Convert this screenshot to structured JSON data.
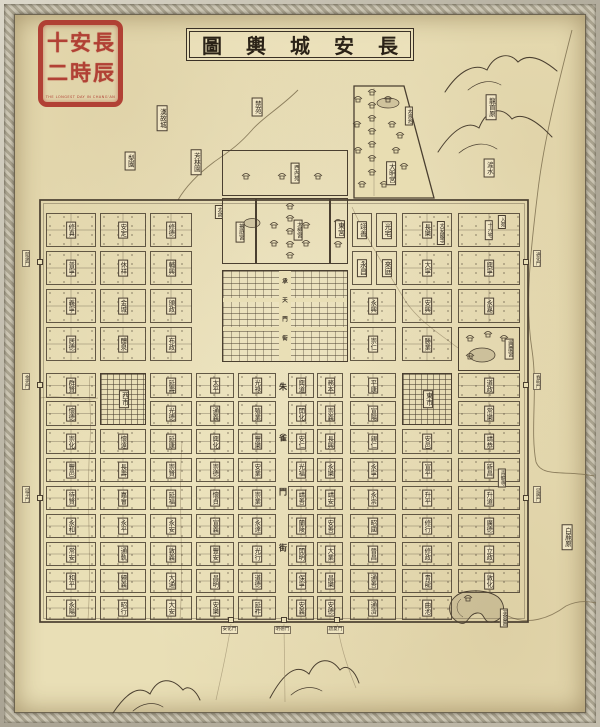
{
  "title": {
    "text": "長安城輿圖",
    "chars": [
      "圖",
      "輿",
      "城",
      "安",
      "長"
    ]
  },
  "seal": {
    "name": "長安十二時辰",
    "rows": [
      [
        "十",
        "安",
        "長"
      ],
      [
        "二",
        "時",
        "辰"
      ]
    ],
    "caption": "THE LONGEST DAY IN CHANG'AN"
  },
  "colors": {
    "paper": "#e9dfb6",
    "ink": "#4a3f30",
    "seal_red": "#ae352c",
    "water": "#7d6e4f"
  },
  "grid": {
    "cols": [
      {
        "x": 46,
        "w": 50
      },
      {
        "x": 100,
        "w": 46
      },
      {
        "x": 150,
        "w": 42
      },
      {
        "x": 196,
        "w": 38
      },
      {
        "x": 238,
        "w": 38
      },
      {
        "x": 288,
        "w": 26
      },
      {
        "x": 317,
        "w": 26
      },
      {
        "x": 350,
        "w": 46
      },
      {
        "x": 402,
        "w": 50
      },
      {
        "x": 458,
        "w": 62
      }
    ],
    "rows": [
      {
        "y": 213,
        "h": 34
      },
      {
        "y": 251,
        "h": 34
      },
      {
        "y": 289,
        "h": 34
      },
      {
        "y": 327,
        "h": 34
      },
      {
        "y": 373,
        "h": 25
      },
      {
        "y": 401,
        "h": 25
      },
      {
        "y": 429,
        "h": 25
      },
      {
        "y": 458,
        "h": 24
      },
      {
        "y": 486,
        "h": 24
      },
      {
        "y": 514,
        "h": 24
      },
      {
        "y": 542,
        "h": 24
      },
      {
        "y": 569,
        "h": 24
      },
      {
        "y": 596,
        "h": 24
      }
    ]
  },
  "wards": [
    {
      "n": "修真",
      "c": 1,
      "r": 1
    },
    {
      "n": "安定",
      "c": 2,
      "r": 1
    },
    {
      "n": "修德",
      "c": 3,
      "r": 1
    },
    {
      "n": "長樂",
      "c": 9,
      "r": 1
    },
    {
      "n": "十六宅",
      "c": 10,
      "r": 1
    },
    {
      "n": "普寧",
      "c": 1,
      "r": 2
    },
    {
      "n": "休祥",
      "c": 2,
      "r": 2
    },
    {
      "n": "輔興",
      "c": 3,
      "r": 2
    },
    {
      "n": "大寧",
      "c": 9,
      "r": 2
    },
    {
      "n": "興寧",
      "c": 10,
      "r": 2
    },
    {
      "n": "義寧",
      "c": 1,
      "r": 3
    },
    {
      "n": "金城",
      "c": 2,
      "r": 3
    },
    {
      "n": "頒政",
      "c": 3,
      "r": 3
    },
    {
      "n": "永興",
      "c": 8,
      "r": 3
    },
    {
      "n": "安興",
      "c": 9,
      "r": 3
    },
    {
      "n": "永嘉",
      "c": 10,
      "r": 3
    },
    {
      "n": "居德",
      "c": 1,
      "r": 4
    },
    {
      "n": "醴泉",
      "c": 2,
      "r": 4
    },
    {
      "n": "布政",
      "c": 3,
      "r": 4
    },
    {
      "n": "崇仁",
      "c": 8,
      "r": 4
    },
    {
      "n": "勝業",
      "c": 9,
      "r": 4
    },
    {
      "n": "群賢",
      "c": 1,
      "r": 5
    },
    {
      "n": "延壽",
      "c": 3,
      "r": 5
    },
    {
      "n": "太平",
      "c": 4,
      "r": 5
    },
    {
      "n": "光祿",
      "c": 5,
      "r": 5
    },
    {
      "n": "興道",
      "c": 6,
      "r": 5
    },
    {
      "n": "務本",
      "c": 7,
      "r": 5
    },
    {
      "n": "平康",
      "c": 8,
      "r": 5
    },
    {
      "n": "道政",
      "c": 10,
      "r": 5
    },
    {
      "n": "懷德",
      "c": 1,
      "r": 6
    },
    {
      "n": "光德",
      "c": 3,
      "r": 6
    },
    {
      "n": "通義",
      "c": 4,
      "r": 6
    },
    {
      "n": "殖業",
      "c": 5,
      "r": 6
    },
    {
      "n": "開化",
      "c": 6,
      "r": 6
    },
    {
      "n": "崇義",
      "c": 7,
      "r": 6
    },
    {
      "n": "宣陽",
      "c": 8,
      "r": 6
    },
    {
      "n": "常樂",
      "c": 10,
      "r": 6
    },
    {
      "n": "崇化",
      "c": 1,
      "r": 7
    },
    {
      "n": "懷遠",
      "c": 2,
      "r": 7
    },
    {
      "n": "延康",
      "c": 3,
      "r": 7
    },
    {
      "n": "興化",
      "c": 4,
      "r": 7
    },
    {
      "n": "豐樂",
      "c": 5,
      "r": 7
    },
    {
      "n": "安仁",
      "c": 6,
      "r": 7
    },
    {
      "n": "長興",
      "c": 7,
      "r": 7
    },
    {
      "n": "親仁",
      "c": 8,
      "r": 7
    },
    {
      "n": "安邑",
      "c": 9,
      "r": 7
    },
    {
      "n": "靖恭",
      "c": 10,
      "r": 7
    },
    {
      "n": "豐邑",
      "c": 1,
      "r": 8
    },
    {
      "n": "長壽",
      "c": 2,
      "r": 8
    },
    {
      "n": "崇賢",
      "c": 3,
      "r": 8
    },
    {
      "n": "崇德",
      "c": 4,
      "r": 8
    },
    {
      "n": "安業",
      "c": 5,
      "r": 8
    },
    {
      "n": "光福",
      "c": 6,
      "r": 8
    },
    {
      "n": "永樂",
      "c": 7,
      "r": 8
    },
    {
      "n": "永寧",
      "c": 8,
      "r": 8
    },
    {
      "n": "宣平",
      "c": 9,
      "r": 8
    },
    {
      "n": "新昌",
      "c": 10,
      "r": 8
    },
    {
      "n": "待賢",
      "c": 1,
      "r": 9
    },
    {
      "n": "嘉會",
      "c": 2,
      "r": 9
    },
    {
      "n": "延福",
      "c": 3,
      "r": 9
    },
    {
      "n": "懷貞",
      "c": 4,
      "r": 9
    },
    {
      "n": "崇業",
      "c": 5,
      "r": 9
    },
    {
      "n": "靖善",
      "c": 6,
      "r": 9
    },
    {
      "n": "靖安",
      "c": 7,
      "r": 9
    },
    {
      "n": "永崇",
      "c": 8,
      "r": 9
    },
    {
      "n": "升平",
      "c": 9,
      "r": 9
    },
    {
      "n": "升道",
      "c": 10,
      "r": 9
    },
    {
      "n": "永和",
      "c": 1,
      "r": 10
    },
    {
      "n": "永平",
      "c": 2,
      "r": 10
    },
    {
      "n": "永安",
      "c": 3,
      "r": 10
    },
    {
      "n": "宣義",
      "c": 4,
      "r": 10
    },
    {
      "n": "永達",
      "c": 5,
      "r": 10
    },
    {
      "n": "蘭陵",
      "c": 6,
      "r": 10
    },
    {
      "n": "安善",
      "c": 7,
      "r": 10
    },
    {
      "n": "昭國",
      "c": 8,
      "r": 10
    },
    {
      "n": "修行",
      "c": 9,
      "r": 10
    },
    {
      "n": "廣德",
      "c": 10,
      "r": 10
    },
    {
      "n": "常安",
      "c": 1,
      "r": 11
    },
    {
      "n": "通軌",
      "c": 2,
      "r": 11
    },
    {
      "n": "敦義",
      "c": 3,
      "r": 11
    },
    {
      "n": "豐安",
      "c": 4,
      "r": 11
    },
    {
      "n": "光行",
      "c": 5,
      "r": 11
    },
    {
      "n": "開明",
      "c": 6,
      "r": 11
    },
    {
      "n": "大業",
      "c": 7,
      "r": 11
    },
    {
      "n": "晉昌",
      "c": 8,
      "r": 11
    },
    {
      "n": "修政",
      "c": 9,
      "r": 11
    },
    {
      "n": "立政",
      "c": 10,
      "r": 11
    },
    {
      "n": "和平",
      "c": 1,
      "r": 12
    },
    {
      "n": "歸義",
      "c": 2,
      "r": 12
    },
    {
      "n": "大通",
      "c": 3,
      "r": 12
    },
    {
      "n": "昌明",
      "c": 4,
      "r": 12
    },
    {
      "n": "道德",
      "c": 5,
      "r": 12
    },
    {
      "n": "保寧",
      "c": 6,
      "r": 12
    },
    {
      "n": "昌樂",
      "c": 7,
      "r": 12
    },
    {
      "n": "通善",
      "c": 8,
      "r": 12
    },
    {
      "n": "青龍",
      "c": 9,
      "r": 12
    },
    {
      "n": "敦化",
      "c": 10,
      "r": 12
    },
    {
      "n": "永陽",
      "c": 1,
      "r": 13
    },
    {
      "n": "昭行",
      "c": 2,
      "r": 13
    },
    {
      "n": "大安",
      "c": 3,
      "r": 13
    },
    {
      "n": "安樂",
      "c": 4,
      "r": 13
    },
    {
      "n": "延祚",
      "c": 5,
      "r": 13
    },
    {
      "n": "安義",
      "c": 6,
      "r": 13
    },
    {
      "n": "安德",
      "c": 7,
      "r": 13
    },
    {
      "n": "通濟",
      "c": 8,
      "r": 13
    },
    {
      "n": "曲池",
      "c": 9,
      "r": 13
    }
  ],
  "places": [
    {
      "id": "west-inner-garden",
      "cls": "wallbox",
      "box": [
        222,
        150,
        126,
        46
      ],
      "n": "西內苑",
      "l": [
        294,
        172
      ]
    },
    {
      "id": "yeting-palace",
      "cls": "wallbox",
      "box": [
        222,
        198,
        34,
        66
      ],
      "n": "掖庭宮",
      "l": [
        239,
        231
      ]
    },
    {
      "id": "taiji-palace",
      "cls": "wallbox",
      "box": [
        256,
        198,
        74,
        66
      ],
      "n": "太極宮",
      "l": [
        297,
        229
      ]
    },
    {
      "id": "east-palace",
      "cls": "wallbox",
      "box": [
        330,
        198,
        18,
        66
      ],
      "n": "東宮",
      "l": [
        339,
        228
      ]
    },
    {
      "id": "imperial-city",
      "cls": "offices",
      "box": [
        222,
        270,
        126,
        92
      ]
    },
    {
      "id": "daming-palace-label",
      "cls": "plbl",
      "n": "大明宮",
      "l": [
        391,
        173
      ],
      "fs": 6.5
    },
    {
      "id": "taiye-pond-label",
      "cls": "plbl",
      "n": "太液池",
      "l": [
        409,
        116
      ],
      "fs": 5
    },
    {
      "id": "xingqing-palace",
      "cls": "wallbox",
      "box": [
        458,
        327,
        62,
        44
      ],
      "n": "興慶宮",
      "l": [
        508,
        348
      ]
    },
    {
      "id": "west-market",
      "cls": "market",
      "box": [
        100,
        373,
        46,
        52
      ],
      "n": "西市",
      "l": [
        123,
        398
      ]
    },
    {
      "id": "east-market",
      "cls": "market",
      "box": [
        402,
        373,
        50,
        52
      ],
      "n": "東市",
      "l": [
        427,
        398
      ]
    },
    {
      "id": "ward-yishan",
      "cls": "smallward",
      "box": [
        352,
        213,
        20,
        34
      ],
      "n": "翊善"
    },
    {
      "id": "ward-guangzhai",
      "cls": "smallward",
      "box": [
        376,
        213,
        21,
        34
      ],
      "n": "光宅"
    },
    {
      "id": "ward-yongchang",
      "cls": "smallward",
      "box": [
        352,
        251,
        20,
        34
      ],
      "n": "永昌"
    },
    {
      "id": "ward-laiting",
      "cls": "smallward",
      "box": [
        376,
        251,
        21,
        34
      ],
      "n": "來庭"
    },
    {
      "id": "daanguo-temple",
      "cls": "tag",
      "n": "大安國寺",
      "l": [
        441,
        233
      ]
    },
    {
      "id": "ruyuan",
      "cls": "tag",
      "n": "入苑",
      "l": [
        502,
        222
      ]
    },
    {
      "id": "taicang",
      "cls": "tag",
      "n": "太倉",
      "l": [
        219,
        212
      ]
    },
    {
      "id": "qinglong-temple",
      "cls": "tag",
      "n": "青龍寺",
      "l": [
        502,
        478
      ]
    },
    {
      "id": "furong-garden",
      "cls": "tag",
      "n": "芙蓉園",
      "l": [
        504,
        618
      ]
    },
    {
      "id": "han-old-city",
      "cls": "obox",
      "n": "漢故城",
      "l": [
        162,
        118
      ]
    },
    {
      "id": "forbidden-park",
      "cls": "obox",
      "n": "禁苑",
      "l": [
        257,
        107
      ]
    },
    {
      "id": "pear-garden",
      "cls": "obox",
      "n": "梨園",
      "l": [
        130,
        161
      ]
    },
    {
      "id": "fanglin-garden",
      "cls": "obox",
      "n": "芳林園",
      "l": [
        196,
        162
      ]
    },
    {
      "id": "longshou-plateau",
      "cls": "obox",
      "n": "龍首原",
      "l": [
        491,
        107
      ]
    },
    {
      "id": "chan-river-label",
      "cls": "obox",
      "n": "滻水",
      "l": [
        489,
        168
      ]
    },
    {
      "id": "bailu-plateau",
      "cls": "obox",
      "n": "白鹿原",
      "l": [
        567,
        537
      ]
    }
  ],
  "gates": {
    "west": [
      {
        "n": "開遠門",
        "y": 262
      },
      {
        "n": "金光門",
        "y": 385
      },
      {
        "n": "延平門",
        "y": 498
      }
    ],
    "east": [
      {
        "n": "通化門",
        "y": 262
      },
      {
        "n": "春明門",
        "y": 385
      },
      {
        "n": "延興門",
        "y": 498
      }
    ],
    "south": [
      {
        "n": "安化門",
        "x": 231
      },
      {
        "n": "明德門",
        "x": 284
      },
      {
        "n": "啟夏門",
        "x": 337
      }
    ]
  },
  "streets": {
    "zhuque": {
      "text": "朱雀門街",
      "x": 283,
      "ys": [
        387,
        438,
        492,
        548
      ],
      "fs": 8
    },
    "chengtian": {
      "text": "承天門街",
      "x": 285,
      "ys": [
        281,
        300,
        319,
        338
      ],
      "fs": 5.5
    }
  },
  "pavilions": [
    [
      372,
      92
    ],
    [
      372,
      105
    ],
    [
      372,
      118
    ],
    [
      372,
      131
    ],
    [
      372,
      144
    ],
    [
      372,
      158
    ],
    [
      372,
      172
    ],
    [
      358,
      99
    ],
    [
      388,
      99
    ],
    [
      357,
      124
    ],
    [
      392,
      124
    ],
    [
      358,
      150
    ],
    [
      396,
      150
    ],
    [
      404,
      166
    ],
    [
      400,
      135
    ],
    [
      362,
      184
    ],
    [
      384,
      184
    ],
    [
      290,
      206
    ],
    [
      290,
      218
    ],
    [
      290,
      231
    ],
    [
      290,
      244
    ],
    [
      274,
      225
    ],
    [
      306,
      225
    ],
    [
      274,
      243
    ],
    [
      306,
      243
    ],
    [
      290,
      255
    ],
    [
      338,
      222
    ],
    [
      338,
      244
    ],
    [
      470,
      338
    ],
    [
      488,
      334
    ],
    [
      504,
      338
    ],
    [
      470,
      356
    ],
    [
      246,
      176
    ],
    [
      282,
      176
    ],
    [
      318,
      176
    ],
    [
      468,
      598
    ]
  ]
}
